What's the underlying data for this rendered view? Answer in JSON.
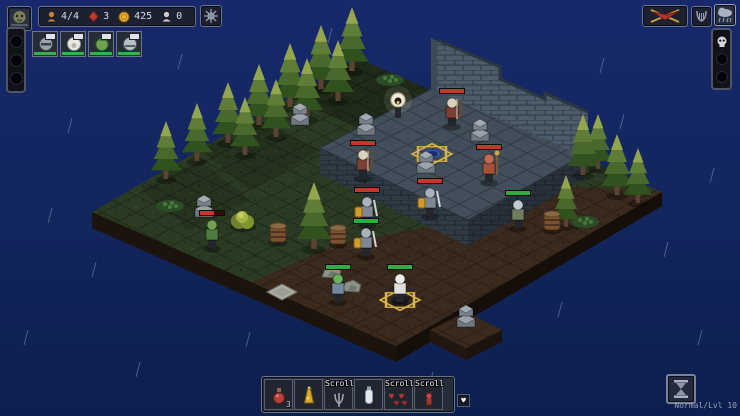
{
  "hud": {
    "resources": [
      {
        "name": "units",
        "value": "4/4"
      },
      {
        "name": "gems",
        "value": "3"
      },
      {
        "name": "gold",
        "value": "425"
      },
      {
        "name": "souls",
        "value": "0"
      }
    ],
    "party": [
      {
        "name": "knight"
      },
      {
        "name": "white-hood"
      },
      {
        "name": "green-creature"
      },
      {
        "name": "round-helm"
      }
    ]
  },
  "bottom_bar": {
    "slots": [
      {
        "label": "",
        "count": "3",
        "icon": "red-potion"
      },
      {
        "label": "",
        "count": "",
        "icon": "yellow-flask"
      },
      {
        "label": "Scroll",
        "count": "",
        "icon": "grey-claw"
      },
      {
        "label": "",
        "count": "",
        "icon": "white-bottle"
      },
      {
        "label": "Scroll",
        "count": "",
        "icon": "hearts"
      },
      {
        "label": "Scroll",
        "count": "",
        "icon": "red-imp"
      }
    ],
    "heart_button": "♥"
  },
  "status": {
    "difficulty": "Normal/Lvl 10"
  },
  "colors": {
    "hp_enemy": "#c0392b",
    "hp_player": "#2fae3f",
    "gold": "#d8b24a",
    "bg": "#13255c"
  },
  "scene": {
    "trees": [
      [
        352,
        70,
        1.05
      ],
      [
        321,
        88,
        1.05
      ],
      [
        290,
        106,
        1.05
      ],
      [
        259,
        124,
        1.0
      ],
      [
        228,
        142,
        1.0
      ],
      [
        197,
        160,
        0.95
      ],
      [
        166,
        178,
        0.95
      ],
      [
        338,
        100,
        1.0
      ],
      [
        307,
        118,
        1.0
      ],
      [
        276,
        136,
        0.95
      ],
      [
        245,
        154,
        0.95
      ],
      [
        598,
        168,
        0.9
      ],
      [
        583,
        174,
        1.0
      ],
      [
        617,
        194,
        1.0
      ],
      [
        638,
        202,
        0.9
      ],
      [
        566,
        226,
        0.85
      ],
      [
        314,
        248,
        1.1
      ]
    ],
    "units": [
      {
        "name": "enemy-lizard",
        "x": 212,
        "y": 248,
        "side": "enemy",
        "hp": 0.6,
        "body": "#4f7c3e",
        "head": "#73a257",
        "type": "melee"
      },
      {
        "name": "enemy-skeleton-archer-1",
        "x": 363,
        "y": 178,
        "side": "enemy",
        "hp": 1,
        "body": "#7b3f33",
        "head": "#d9d2bd",
        "type": "bow"
      },
      {
        "name": "enemy-skeleton-archer-2",
        "x": 452,
        "y": 126,
        "side": "enemy",
        "hp": 1,
        "body": "#7b3f33",
        "head": "#d9d2bd",
        "type": "bow"
      },
      {
        "name": "enemy-demon",
        "x": 489,
        "y": 182,
        "side": "enemy",
        "hp": 1,
        "body": "#a6503a",
        "head": "#c06a4e",
        "type": "staff"
      },
      {
        "name": "enemy-knight-1",
        "x": 367,
        "y": 225,
        "side": "enemy",
        "hp": 1,
        "body": "#7d8894",
        "head": "#aab3bd",
        "type": "shield"
      },
      {
        "name": "enemy-knight-2",
        "x": 430,
        "y": 216,
        "side": "enemy",
        "hp": 1,
        "body": "#7d8894",
        "head": "#aab3bd",
        "type": "shield"
      },
      {
        "name": "party-knight",
        "x": 366,
        "y": 256,
        "side": "player",
        "hp": 1,
        "body": "#7d8894",
        "head": "#aab3bd",
        "type": "shield"
      },
      {
        "name": "party-green-creature",
        "x": 338,
        "y": 302,
        "side": "player",
        "hp": 1,
        "body": "#7688a0",
        "head": "#69b35e",
        "type": "melee"
      },
      {
        "name": "party-white-robe",
        "x": 400,
        "y": 302,
        "side": "player",
        "hp": 1,
        "body": "#dfe0dc",
        "head": "#eeeeea",
        "type": "melee",
        "selected": true
      },
      {
        "name": "party-round-helm",
        "x": 518,
        "y": 228,
        "side": "player",
        "hp": 1,
        "body": "#6e7d62",
        "head": "#c6cbd1",
        "type": "melee"
      }
    ],
    "props": [
      [
        "lamp",
        398,
        118
      ],
      [
        "portal",
        432,
        154
      ],
      [
        "pillar",
        300,
        124
      ],
      [
        "pillar",
        366,
        134
      ],
      [
        "pillar",
        480,
        140
      ],
      [
        "pillar",
        426,
        172
      ],
      [
        "pillar",
        466,
        326
      ],
      [
        "pillar",
        204,
        216
      ],
      [
        "barrel",
        278,
        242
      ],
      [
        "barrel",
        338,
        244
      ],
      [
        "barrel",
        552,
        230
      ],
      [
        "bush",
        243,
        226
      ],
      [
        "plant",
        585,
        222
      ],
      [
        "plant",
        170,
        206
      ],
      [
        "plant",
        390,
        80
      ],
      [
        "slab",
        282,
        292
      ],
      [
        "rock",
        352,
        288
      ],
      [
        "rock",
        332,
        274
      ]
    ],
    "rain": [
      [
        72,
        118
      ],
      [
        52,
        208
      ],
      [
        96,
        262
      ],
      [
        140,
        362
      ],
      [
        182,
        54
      ],
      [
        250,
        332
      ],
      [
        332,
        28
      ],
      [
        433,
        372
      ],
      [
        562,
        302
      ],
      [
        604,
        58
      ],
      [
        624,
        114
      ],
      [
        668,
        242
      ],
      [
        702,
        330
      ],
      [
        714,
        168
      ],
      [
        288,
        390
      ],
      [
        28,
        330
      ]
    ]
  }
}
